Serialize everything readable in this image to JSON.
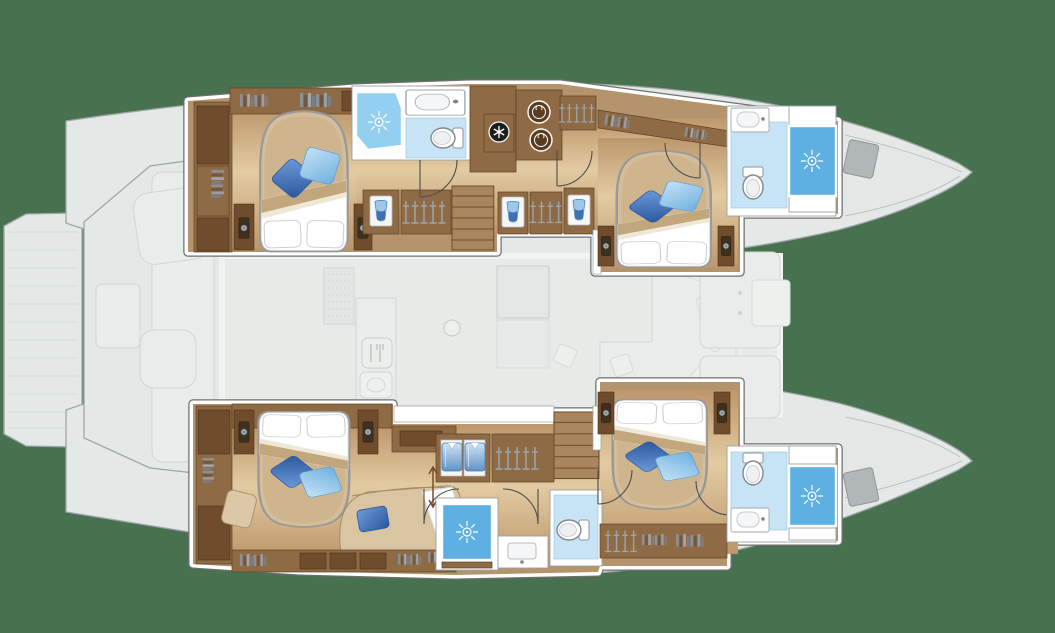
{
  "meta": {
    "title": "Catamaran yacht floor plan — lower deck, 4-cabin layout",
    "aria_label": "Top-down floor plan of a sailing catamaran with bows to the right. Each hull holds an aft double cabin and a forward double cabin with en-suite shower rooms, wardrobes and companionway stairs. The central saloon, galley, cockpit and swim platform are shown faded."
  },
  "background": "#48714f",
  "palette": {
    "bg": "#48714f",
    "deckFill": "#f2f3f4",
    "deckLine": "#a6abad",
    "deckSoft": "#f6f7f8",
    "deckSoftLine": "#dcdedf",
    "frameLine": "#6f6f6f",
    "woodBand": "#8f6b45",
    "woodEdge": "#5c4026",
    "woodDark": "#6e4c2c",
    "woodBase": "#b3946c",
    "stairWood": "#a9865e",
    "showerLight": "#93cff0",
    "showerDeep": "#5fb0e2",
    "bathFloor": "#c6e4f5",
    "bedBase": "#d5bd99",
    "pillowDark": "#2e59a2",
    "pillowLight": "#79b6e2"
  },
  "layout": {
    "orientation": "bows to the right, plan view",
    "hulls": [
      {
        "id": "port-hull",
        "position": "top",
        "rooms": [
          {
            "name": "aft-cabin",
            "features": [
              "double-bed",
              "blue-cushions",
              "nightstands-with-lamps",
              "wardrobe-column",
              "bookshelf"
            ]
          },
          {
            "name": "aft-bathroom",
            "features": [
              "corner-shower",
              "washbasin",
              "toilet"
            ]
          },
          {
            "name": "companionway",
            "features": [
              "stairs",
              "hanging-lockers",
              "vanity-niches",
              "washer",
              "dryer",
              "vent-fan",
              "doors"
            ]
          },
          {
            "name": "forward-cabin",
            "features": [
              "double-bed",
              "blue-cushions",
              "nightstands-with-lamps"
            ]
          },
          {
            "name": "forward-bathroom",
            "features": [
              "washbasin",
              "toilet",
              "shower-cubicle"
            ]
          }
        ]
      },
      {
        "id": "starboard-hull",
        "position": "bottom",
        "rooms": [
          {
            "name": "aft-cabin",
            "features": [
              "double-bed",
              "blue-cushions",
              "nightstands-with-lamps",
              "chaise-sofa",
              "ottoman",
              "bookshelves",
              "desk"
            ]
          },
          {
            "name": "companionway",
            "features": [
              "stairs",
              "shirt-locker",
              "hanging-locker",
              "doors",
              "height-arrow"
            ]
          },
          {
            "name": "shower-room",
            "features": [
              "shower-cubicle",
              "washbasin"
            ]
          },
          {
            "name": "toilet-room",
            "features": [
              "toilet"
            ]
          },
          {
            "name": "forward-cabin",
            "features": [
              "double-bed",
              "blue-cushions",
              "nightstands-with-lamps",
              "hanging-locker",
              "bookshelf"
            ]
          },
          {
            "name": "forward-bathroom",
            "features": [
              "toilet",
              "washbasin",
              "shower-cubicle"
            ]
          }
        ]
      }
    ],
    "center_faded": {
      "name": "main-deck-ghost",
      "features": [
        "swim-platform",
        "aft-cockpit-bench",
        "cockpit-table",
        "saloon",
        "galley-with-cutlery-icon",
        "galley-sink",
        "dining-table",
        "l-shaped-sofa",
        "scatter-pillows",
        "mast-post",
        "foredeck-cockpit",
        "anchor-windlass"
      ]
    }
  },
  "icons": [
    "sun-jet-shower-icon",
    "clothes-hanger-icon",
    "washer-icon",
    "dryer-icon",
    "vent-fan-icon",
    "cutlery-icon",
    "lamp-icon",
    "toilet-icon",
    "washbasin-icon",
    "shirt-icon",
    "water-glass-icon",
    "double-arrow-icon"
  ]
}
